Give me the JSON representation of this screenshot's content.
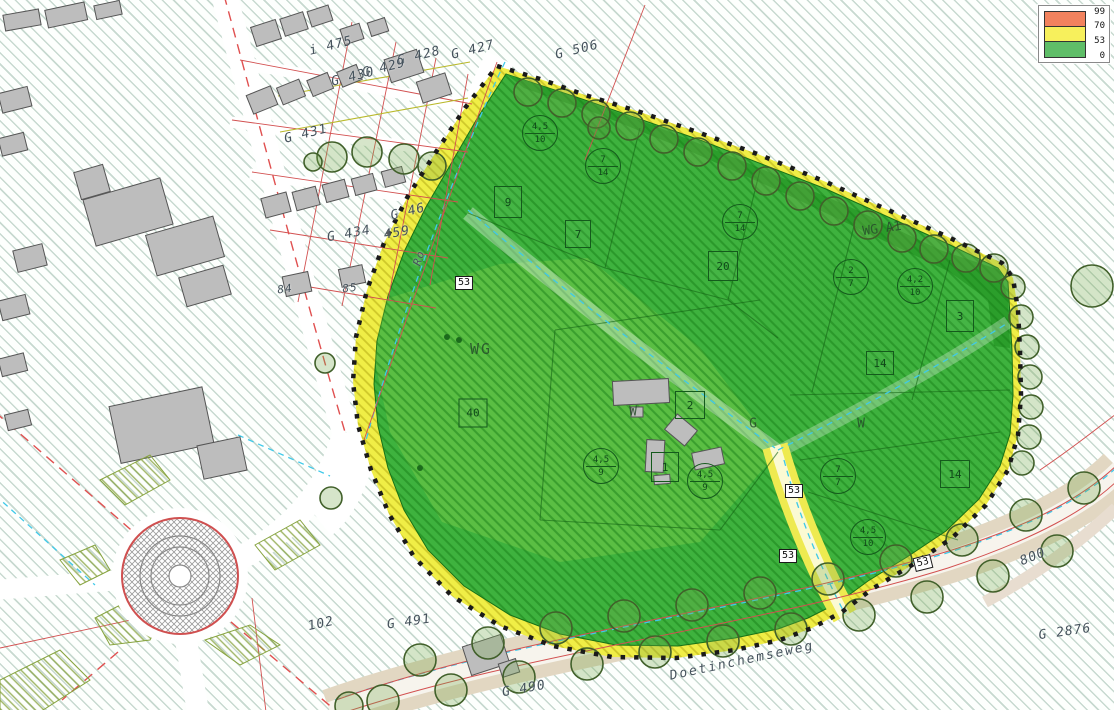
{
  "legend": {
    "ticks": [
      "99",
      "70",
      "53",
      "0"
    ],
    "band_colors": [
      "#f2825e",
      "#f7f05c",
      "#5fbe68"
    ]
  },
  "parcel_labels": [
    "i 475",
    "G 428",
    "G 427",
    "G 429",
    "G 430",
    "G 506",
    "G 431",
    "G 46",
    "G 434",
    "459",
    "84",
    "85",
    "102",
    "G 491",
    "G 490",
    "G 2876",
    "800"
  ],
  "road_labels": {
    "doetinchemseweg": "Doetinchemseweg",
    "ro": "Ro"
  },
  "zone_labels": {
    "wg": "WG",
    "wg_a1": "WG A1",
    "w_center": "W",
    "g_center": "G",
    "w_east": "W"
  },
  "noise_markers": [
    "53",
    "53",
    "53",
    "53"
  ],
  "plot_numbers": [
    "9",
    "7",
    "20",
    "40",
    "2",
    "1",
    "3",
    "14",
    "14"
  ],
  "height_circles": [
    {
      "top": "4,5",
      "bottom": "10"
    },
    {
      "top": "7",
      "bottom": "14"
    },
    {
      "top": "7",
      "bottom": "14"
    },
    {
      "top": "2",
      "bottom": "7"
    },
    {
      "top": "4,2",
      "bottom": "10"
    },
    {
      "top": "4,5",
      "bottom": "9"
    },
    {
      "top": "4,5",
      "bottom": "9"
    },
    {
      "top": "7",
      "bottom": "7"
    },
    {
      "top": "4,5",
      "bottom": "10"
    }
  ],
  "colors": {
    "site_green": "#3eb23e",
    "site_dark_green": "#2b9e2b",
    "buffer_yellow": "#f0ee46",
    "legend_orange": "#f2825e",
    "legend_yellow": "#f7f05c",
    "legend_green": "#5fbe68",
    "parcel_red": "#d25050",
    "water_cyan": "#3fc9e9"
  }
}
